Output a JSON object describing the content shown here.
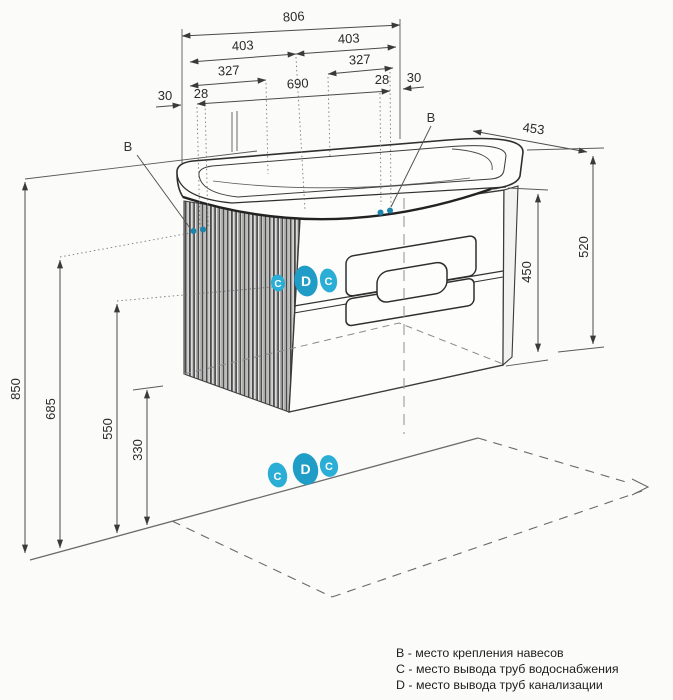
{
  "drawing": {
    "dims": {
      "w_total": "806",
      "w_half_l": "403",
      "w_half_r": "403",
      "w_inner_l": "327",
      "w_inner_r": "327",
      "off_l_outer": "30",
      "off_l_inner": "28",
      "w_span": "690",
      "off_r_inner": "28",
      "off_r_outer": "30",
      "depth": "453",
      "h_cabinet": "450",
      "h_side": "520",
      "h_total": "850",
      "h_hanger": "685",
      "h_pipes": "550",
      "h_bottom": "330"
    },
    "points": {
      "hanger_left": "B",
      "hanger_right": "B"
    },
    "markers": {
      "front": [
        "C",
        "D",
        "C"
      ],
      "wall": [
        "C",
        "D",
        "C"
      ]
    },
    "legend": {
      "line_b": "B - место крепления навесов",
      "line_c": "C - место вывода труб водоснабжения",
      "line_d": "D - место вывода труб канализации"
    },
    "colors": {
      "marker_fill": "#2aaed6",
      "dot_fill": "#1d84ab",
      "line": "#3a3a3a",
      "dim_line": "#4a4a4a",
      "background": "#fbfbfa"
    }
  }
}
